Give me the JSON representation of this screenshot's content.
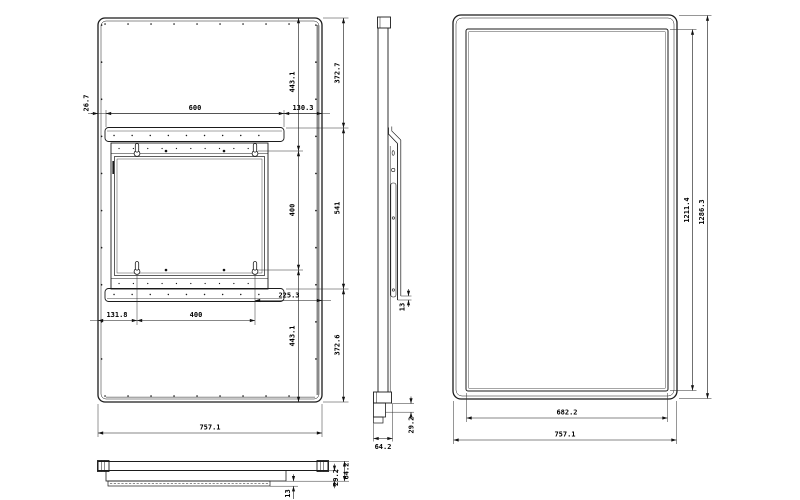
{
  "back_view": {
    "top_chain": {
      "left": "26.7",
      "center": "600",
      "right": "130.3"
    },
    "vesa_chain": {
      "top": "443.1",
      "center": "400",
      "bottom": "443.1"
    },
    "outer_chain": {
      "top": "372.7",
      "center": "541",
      "bottom": "372.6"
    },
    "bottom_chain": {
      "left": "131.8",
      "center": "400",
      "right": "225.3"
    },
    "overall_width": "757.1"
  },
  "side_view": {
    "bracket_offset": "13",
    "step_depth": "29.2",
    "overall_depth": "64.2"
  },
  "front_view": {
    "display_height": "1211.4",
    "overall_height": "1286.3",
    "display_width": "682.2",
    "overall_width": "757.1"
  },
  "top_view": {
    "overall_depth": "64.2",
    "step_depth": "29.2",
    "glass_thickness": "13"
  }
}
